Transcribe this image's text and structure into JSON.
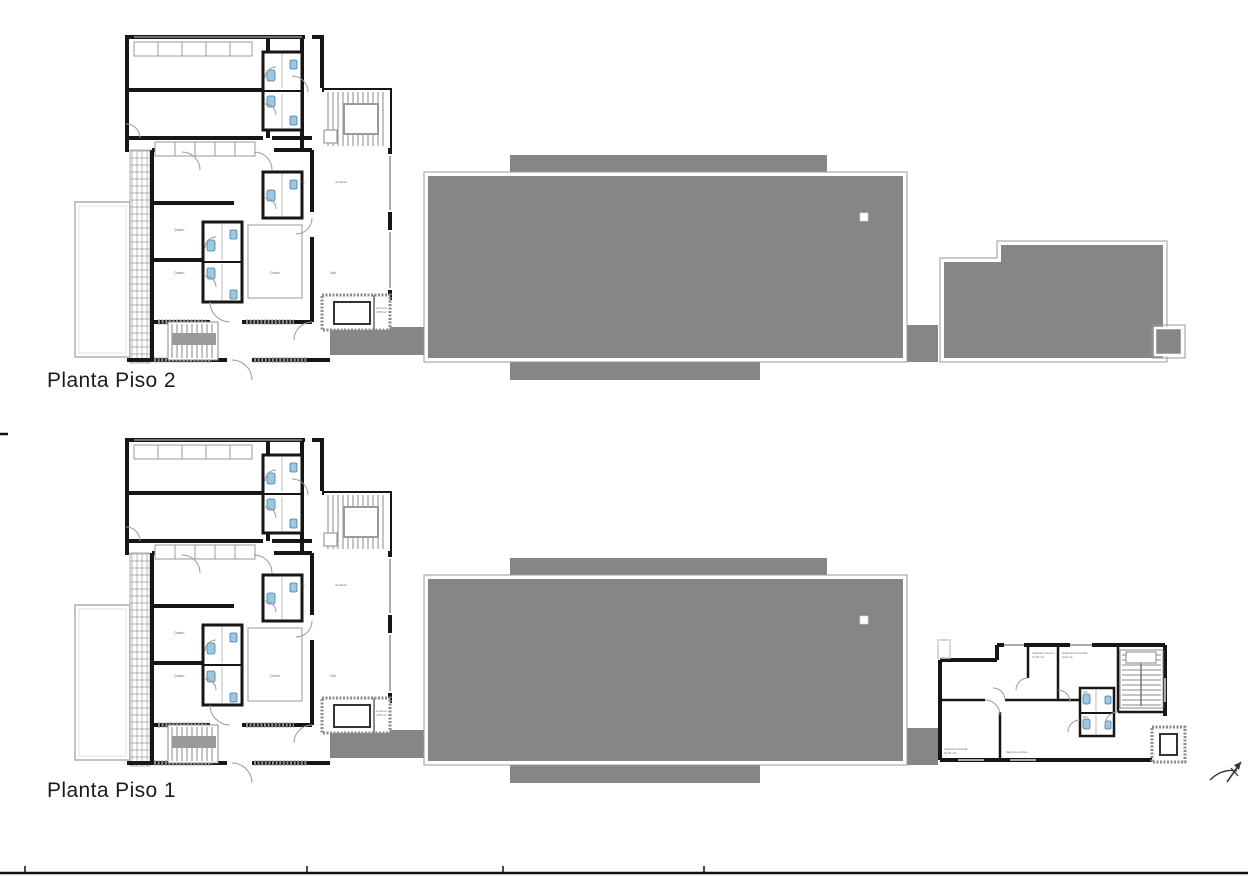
{
  "document": {
    "type": "architectural-floor-plans",
    "background": "#ffffff"
  },
  "plans": [
    {
      "id": "piso2",
      "title": "Planta Piso 2"
    },
    {
      "id": "piso1",
      "title": "Planta Piso 1"
    }
  ],
  "house_labels": {
    "bedroom1": "Quarto",
    "bedroom2": "Quarto",
    "master": "Closet",
    "hall": "Hall",
    "is": "I.S.",
    "vestibule": "Vestíbulo",
    "storage": "Arrumos",
    "storage_area": "3,85 m2"
  },
  "annex_labels": {
    "office1": "Gabinete Técnico",
    "office1_area": "10,00 m2",
    "office2": "Gabinete Recepção",
    "office2_area": "9,00 m2",
    "direction": "Gabinete Direcção",
    "direction_area": "20,00 m2",
    "meeting": "Sala de reuniões",
    "wc1": "WC",
    "wc2": "WC"
  },
  "colors": {
    "roof_gray": "#868686",
    "wall_black": "#161616",
    "fixture_blue": "#9ec7e0",
    "fixture_blue_dark": "#4179a8",
    "line_gray": "#999999"
  }
}
